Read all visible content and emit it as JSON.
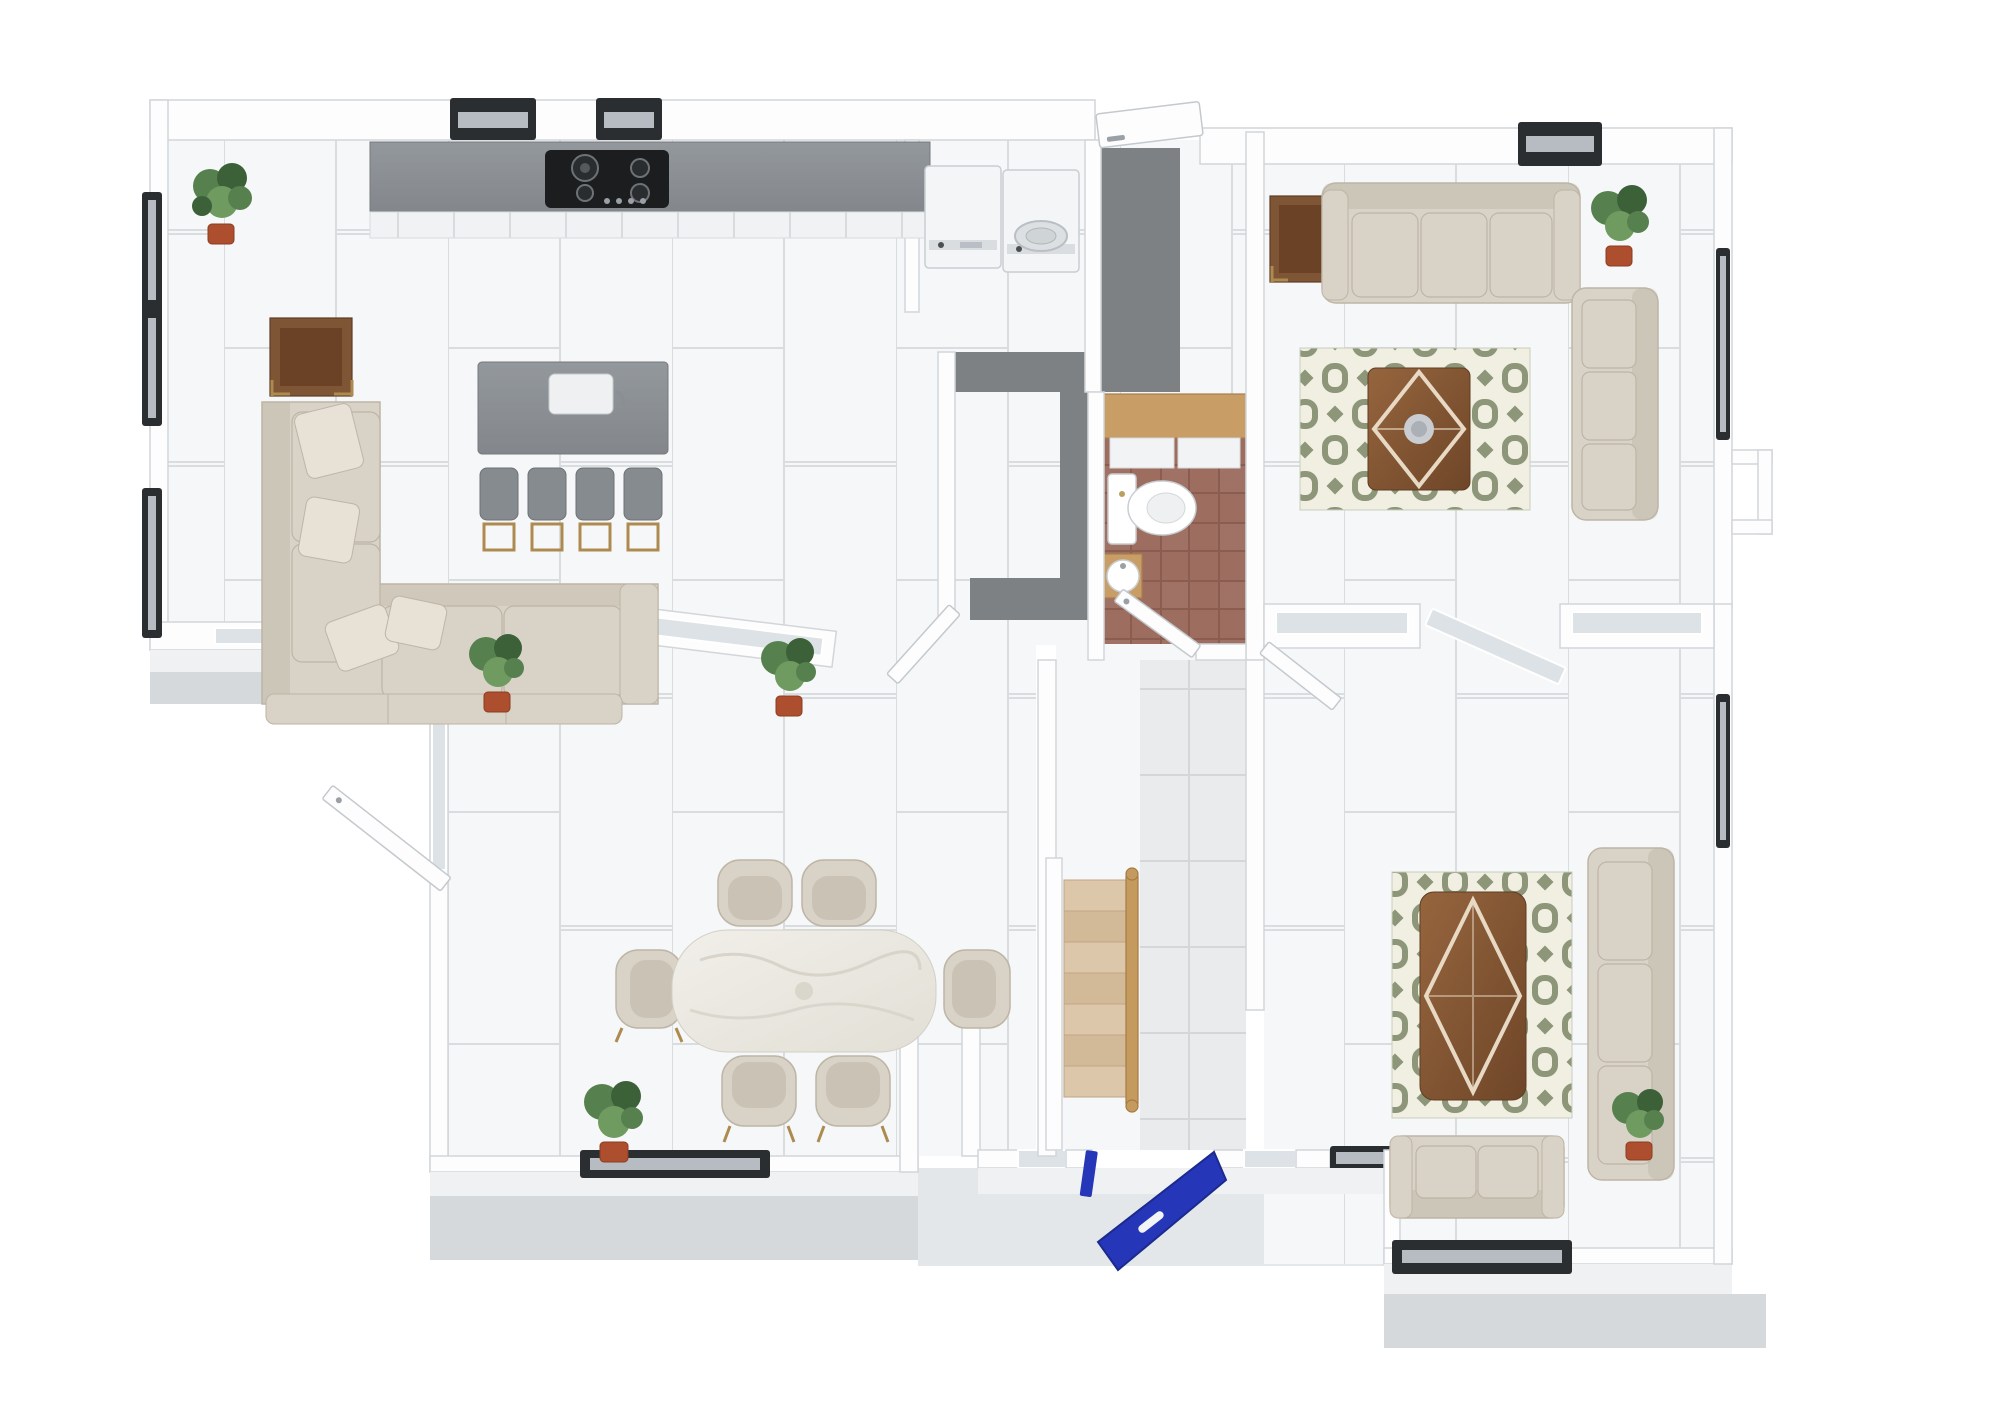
{
  "title": "3D rendered ground-floor plan, top-down view",
  "colors": {
    "wall": "#fdfdfd",
    "wall_edge": "#d2d6da",
    "wall_face": "#eff1f3",
    "floor": "#f6f7f8",
    "tile_line": "#dadde0",
    "entry_tile": "#e9ebed",
    "entry_line": "#d3d7da",
    "porch": "#d5d9dc",
    "porch_light": "#e4e7ea",
    "carpet": "#7d8184",
    "counter": "#8f9498",
    "counter_edge": "#75797d",
    "counter_dark": "#85898d",
    "hob": "#1b1d1f",
    "appliance": "#f4f5f6",
    "sofa": "#d9d3c7",
    "sofa_shade": "#bdb5a6",
    "pillow": "#e7e1d6",
    "rug_green": "#8d9678",
    "rug_cream": "#f0efe2",
    "walnut": "#7e5535",
    "walnut_light": "#9c6a42",
    "oak": "#c89d66",
    "stair": "#ddc7aa",
    "stair_alt": "#d2ba99",
    "rail": "#c49a5e",
    "gold": "#ad8b50",
    "terracotta": "#9d6e60",
    "grout": "#8a5d50",
    "marble": "#edebe5",
    "vein": "#d6d2c8",
    "plant": "#57804f",
    "plant_dark": "#3c6138",
    "plant_light": "#6f9a60",
    "pot": "#ad4f2e",
    "front_door": "#2636b8",
    "window_dark": "#2b2e31",
    "window_glass": "#b6bcc1",
    "glass": "#dde2e6"
  },
  "rooms": [
    {
      "id": "kitchen-living",
      "label": "Open-plan kitchen and lounge"
    },
    {
      "id": "utility",
      "label": "Utility corner with washer and dryer"
    },
    {
      "id": "hallway",
      "label": "Grey-carpeted hallway"
    },
    {
      "id": "bathroom",
      "label": "WC with terracotta tiled floor"
    },
    {
      "id": "living-room",
      "label": "Living room (top right)"
    },
    {
      "id": "dining-room",
      "label": "Dining room (bottom left)"
    },
    {
      "id": "family-room",
      "label": "Family room (bottom right)"
    },
    {
      "id": "entry",
      "label": "Entry hall with staircase and blue front door"
    }
  ],
  "furniture": {
    "kitchen_living": [
      "grey wall counter with 4-burner gas hob",
      "grey island with sink and tap",
      "4 grey bar stools with gold legs",
      "cream L-shaped sectional sofa with pillows",
      "walnut side table with gold base",
      "potted fiddle-leaf plant"
    ],
    "utility": [
      "washing machine",
      "tumble dryer"
    ],
    "bathroom": [
      "oak vanity with white cabinet fronts",
      "white toilet",
      "round basin on oak stand"
    ],
    "living_room": [
      "3-seat cream sofa",
      "3-seat cream sofa (corner)",
      "green geometric rug",
      "walnut coffee table with inlay and decor bowl",
      "walnut side table",
      "potted plant"
    ],
    "dining_room": [
      "white marble dining table",
      "6 cream tub chairs",
      "3 potted plants"
    ],
    "family_room": [
      "green geometric rug",
      "walnut coffee table with diamond inlay",
      "3-seat cream sofa",
      "2-seat cream sofa under window",
      "potted plant"
    ],
    "entry": [
      "timber staircase with handrail",
      "royal blue front door (open)"
    ]
  },
  "fixtures": {
    "windows_count": 13,
    "front_door": "royal blue, open inward",
    "rear_door": "white, open",
    "interior_doors": "white hinged leaves shown ajar",
    "stairs": "7 timber treads with wooden balustrade"
  }
}
